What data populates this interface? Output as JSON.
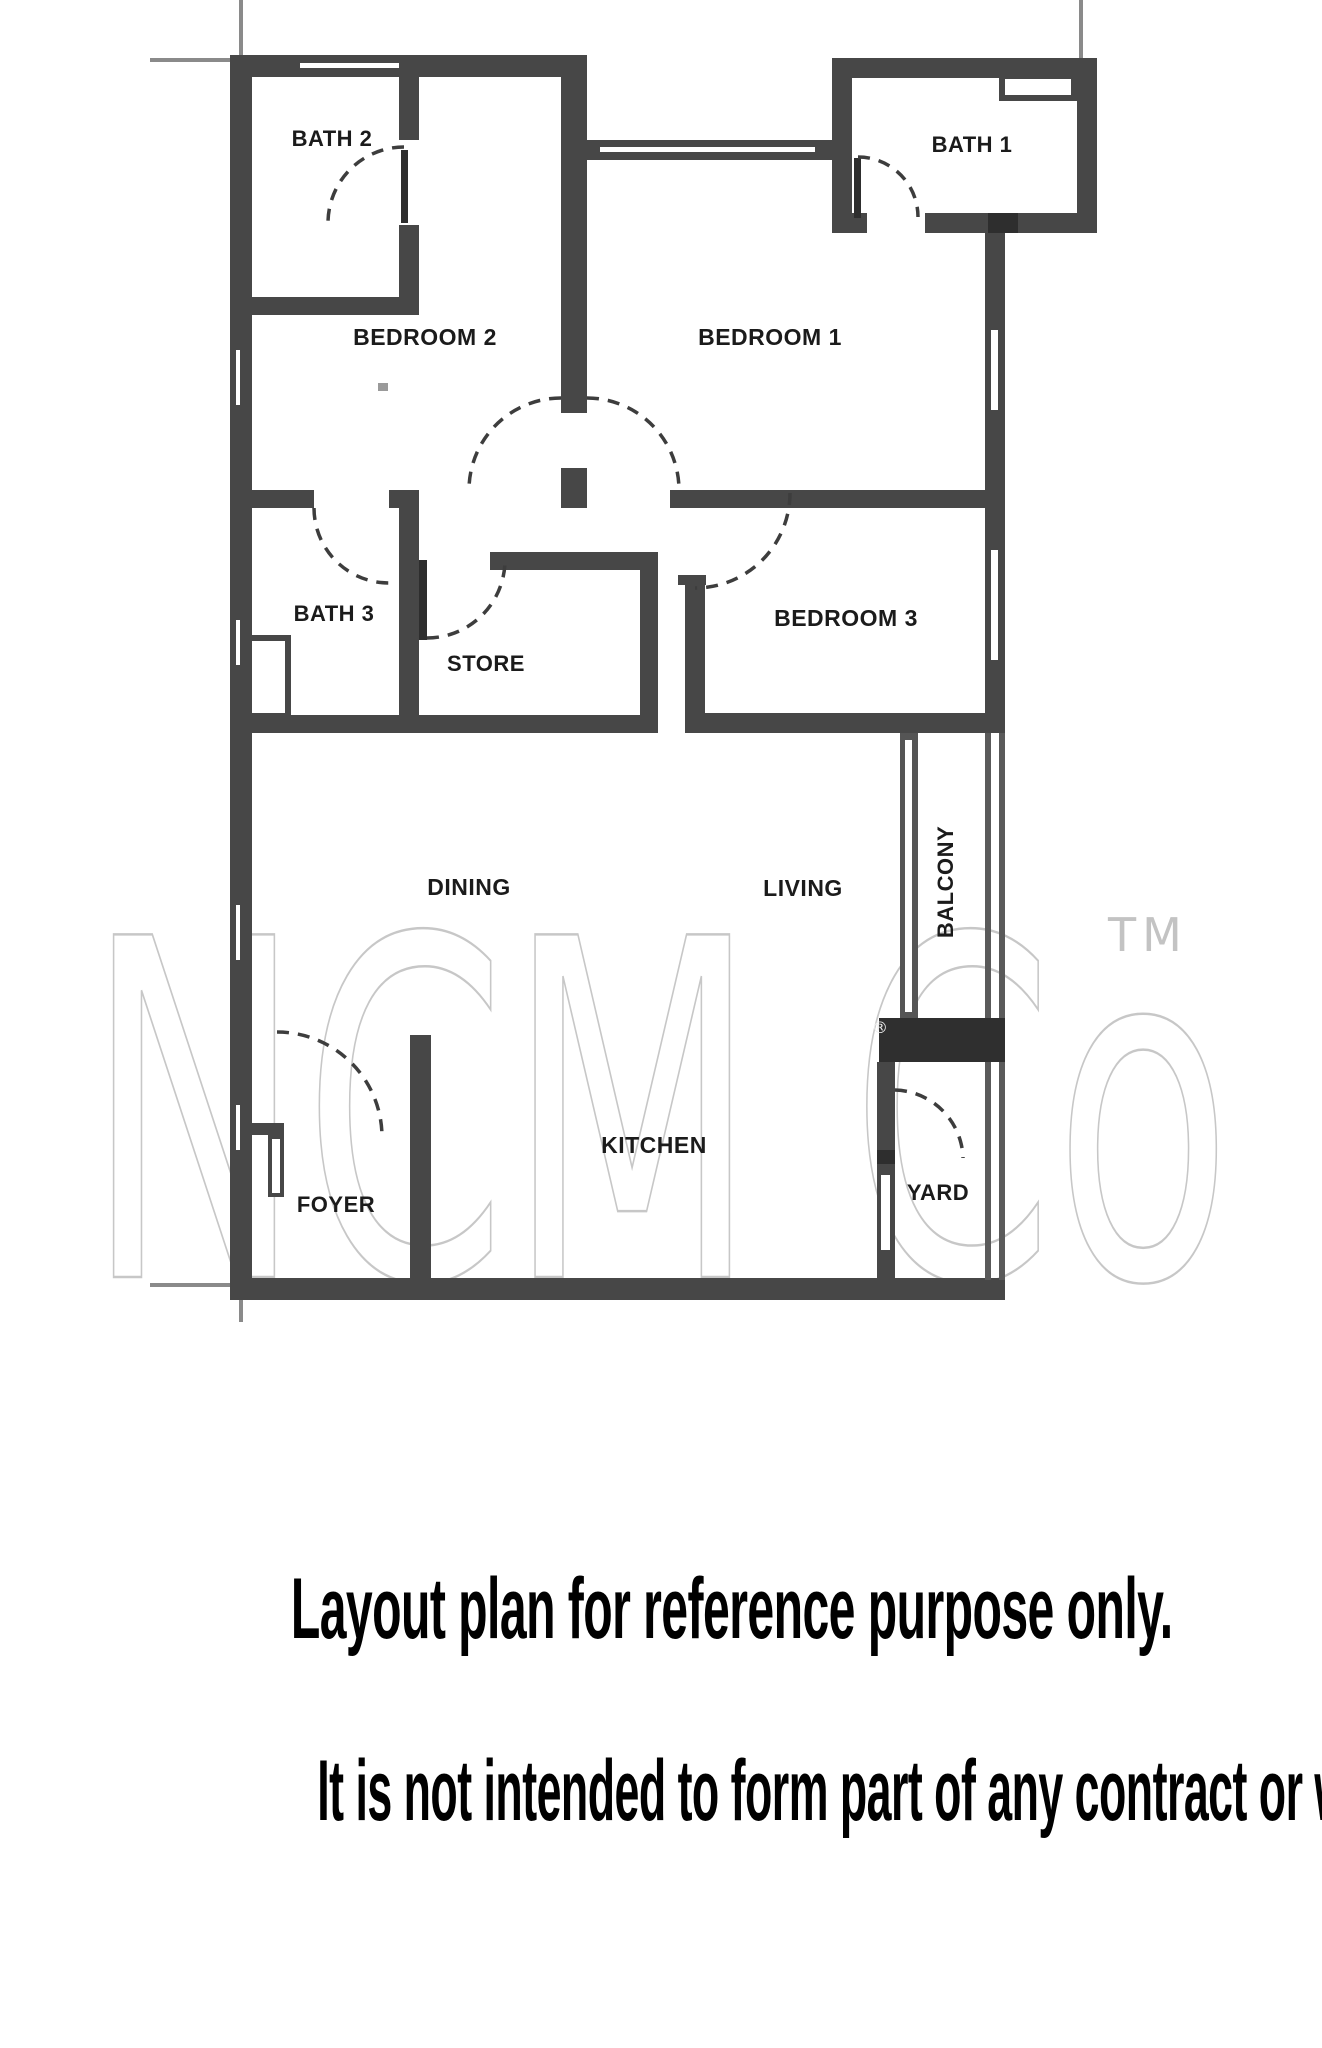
{
  "floor_plan": {
    "rooms": [
      {
        "id": "bath-2",
        "label": "BATH 2"
      },
      {
        "id": "bath-1",
        "label": "BATH 1"
      },
      {
        "id": "bedroom-2",
        "label": "BEDROOM 2"
      },
      {
        "id": "bedroom-1",
        "label": "BEDROOM 1"
      },
      {
        "id": "bath-3",
        "label": "BATH 3"
      },
      {
        "id": "store",
        "label": "STORE"
      },
      {
        "id": "bedroom-3",
        "label": "BEDROOM 3"
      },
      {
        "id": "dining",
        "label": "DINING"
      },
      {
        "id": "living",
        "label": "LIVING"
      },
      {
        "id": "balcony",
        "label": "BALCONY"
      },
      {
        "id": "kitchen",
        "label": "KITCHEN"
      },
      {
        "id": "foyer",
        "label": "FOYER"
      },
      {
        "id": "yard",
        "label": "YARD"
      }
    ],
    "watermark": {
      "brand": "NCM Co",
      "trademark": "TM",
      "registered": "®"
    },
    "colors": {
      "wall": "#474747",
      "wall_dark": "#2e2e2e",
      "arc": "#3d3d3d",
      "watermark_gray": "#c7c7c7"
    }
  },
  "disclaimer": {
    "line1": "Layout plan for reference purpose only.",
    "line2": "It is not intended to form part of any contract or warranty."
  }
}
